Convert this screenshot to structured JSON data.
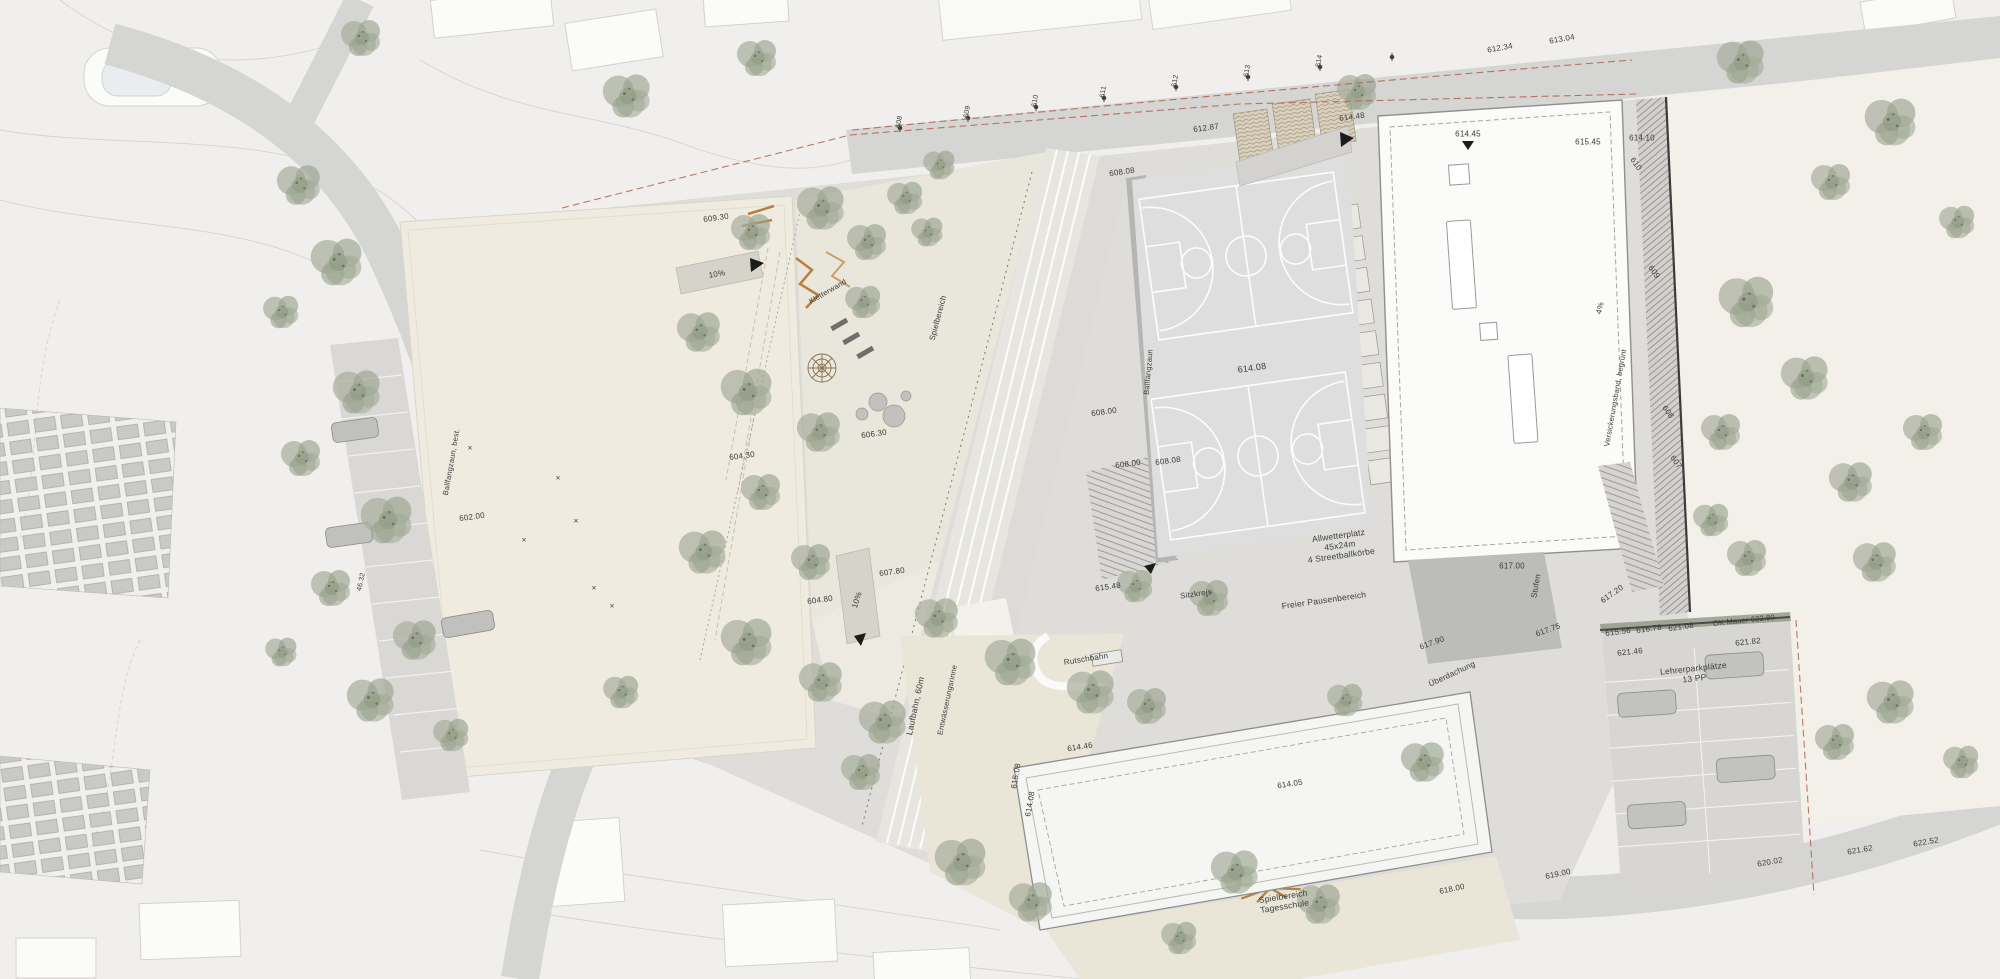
{
  "colors": {
    "ink": "#3a3a38",
    "road": "#d5d5d4",
    "plaza": "#d9d8d5",
    "cream": "#efecdf",
    "beige": "#e9e6d8",
    "lawn": "#f2f0e9",
    "bldg": "#fbfbfa",
    "accent": "#b4604e",
    "tree": "#9aa38f",
    "court_line": "#ffffff",
    "play_equipment": "#b97f3e"
  },
  "legend": {
    "plan_type": "Situationsplan Sportanlagen / Schulareal"
  },
  "annotations": [
    {
      "text": "608",
      "x": 900,
      "y": 122,
      "rot": -80,
      "size": 7,
      "name": "street-elevation"
    },
    {
      "text": "609",
      "x": 968,
      "y": 112,
      "rot": -80,
      "size": 7,
      "name": "street-elevation"
    },
    {
      "text": "610",
      "x": 1036,
      "y": 101,
      "rot": -80,
      "size": 7,
      "name": "street-elevation"
    },
    {
      "text": "611",
      "x": 1104,
      "y": 92,
      "rot": -80,
      "size": 7,
      "name": "street-elevation"
    },
    {
      "text": "612",
      "x": 1176,
      "y": 81,
      "rot": -80,
      "size": 7,
      "name": "street-elevation"
    },
    {
      "text": "613",
      "x": 1248,
      "y": 71,
      "rot": -80,
      "size": 7,
      "name": "street-elevation"
    },
    {
      "text": "614",
      "x": 1320,
      "y": 61,
      "rot": -80,
      "size": 7,
      "name": "street-elevation"
    },
    {
      "text": "612.34",
      "x": 1500,
      "y": 48,
      "rot": -10,
      "size": 8,
      "name": "spot-elevation"
    },
    {
      "text": "613.04",
      "x": 1562,
      "y": 39,
      "rot": -10,
      "size": 8,
      "name": "spot-elevation"
    },
    {
      "text": "612.87",
      "x": 1206,
      "y": 128,
      "rot": -8,
      "size": 8,
      "name": "spot-elevation"
    },
    {
      "text": "614.48",
      "x": 1352,
      "y": 117,
      "rot": -8,
      "size": 8,
      "name": "spot-elevation"
    },
    {
      "text": "614.45",
      "x": 1468,
      "y": 134,
      "rot": 0,
      "size": 8,
      "name": "spot-elevation"
    },
    {
      "text": "615.45",
      "x": 1588,
      "y": 142,
      "rot": 0,
      "size": 8,
      "name": "spot-elevation"
    },
    {
      "text": "614.10",
      "x": 1642,
      "y": 138,
      "rot": 0,
      "size": 8,
      "name": "spot-elevation"
    },
    {
      "text": "610",
      "x": 1636,
      "y": 164,
      "rot": 55,
      "size": 8,
      "name": "contour-label"
    },
    {
      "text": "609",
      "x": 1654,
      "y": 272,
      "rot": 55,
      "size": 8,
      "name": "contour-label"
    },
    {
      "text": "608",
      "x": 1668,
      "y": 412,
      "rot": 55,
      "size": 8,
      "name": "contour-label"
    },
    {
      "text": "607",
      "x": 1676,
      "y": 462,
      "rot": 55,
      "size": 8,
      "name": "contour-label"
    },
    {
      "text": "4%",
      "x": 1600,
      "y": 308,
      "rot": -78,
      "size": 8,
      "name": "slope-label"
    },
    {
      "text": "Versickerungsband, begrünt",
      "x": 1616,
      "y": 398,
      "rot": -80,
      "size": 7.5,
      "name": "feature-label"
    },
    {
      "text": "608.08",
      "x": 1122,
      "y": 172,
      "rot": -8,
      "size": 8,
      "name": "spot-elevation"
    },
    {
      "text": "614.08",
      "x": 1252,
      "y": 368,
      "rot": -8,
      "size": 9,
      "name": "spot-elevation"
    },
    {
      "text": "608.00",
      "x": 1104,
      "y": 412,
      "rot": -8,
      "size": 8,
      "name": "spot-elevation"
    },
    {
      "text": "608.00",
      "x": 1128,
      "y": 464,
      "rot": -8,
      "size": 8,
      "name": "spot-elevation"
    },
    {
      "text": "608.08",
      "x": 1168,
      "y": 461,
      "rot": -8,
      "size": 8,
      "name": "spot-elevation"
    },
    {
      "text": "Ballfangzaun",
      "x": 1149,
      "y": 372,
      "rot": -85,
      "size": 7.5,
      "name": "feature-label"
    },
    {
      "text": "Allwetterplatz\n45x24m\n4 Streetballkörbe",
      "x": 1340,
      "y": 546,
      "rot": -8,
      "size": 8.5,
      "name": "label-allwetterplatz"
    },
    {
      "text": "615.48",
      "x": 1108,
      "y": 587,
      "rot": -8,
      "size": 8,
      "name": "spot-elevation"
    },
    {
      "text": "Sitzkreis",
      "x": 1196,
      "y": 594,
      "rot": -8,
      "size": 8,
      "name": "feature-label"
    },
    {
      "text": "Freier Pausenbereich",
      "x": 1324,
      "y": 601,
      "rot": -8,
      "size": 8.5,
      "name": "label-pausenbereich"
    },
    {
      "text": "617.00",
      "x": 1512,
      "y": 566,
      "rot": 0,
      "size": 8,
      "name": "spot-elevation"
    },
    {
      "text": "617.90",
      "x": 1432,
      "y": 643,
      "rot": -20,
      "size": 8,
      "name": "spot-elevation"
    },
    {
      "text": "617.75",
      "x": 1548,
      "y": 630,
      "rot": -20,
      "size": 8,
      "name": "spot-elevation"
    },
    {
      "text": "Überdachung",
      "x": 1452,
      "y": 674,
      "rot": -25,
      "size": 8,
      "name": "feature-label"
    },
    {
      "text": "Stufen",
      "x": 1536,
      "y": 586,
      "rot": -80,
      "size": 8,
      "name": "feature-label"
    },
    {
      "text": "Laufbahn, 60m",
      "x": 916,
      "y": 706,
      "rot": -78,
      "size": 8.5,
      "name": "label-laufbahn"
    },
    {
      "text": "Entwässerungsrinne",
      "x": 948,
      "y": 700,
      "rot": -78,
      "size": 7.5,
      "name": "feature-label"
    },
    {
      "text": "604.30",
      "x": 742,
      "y": 456,
      "rot": -8,
      "size": 8,
      "name": "spot-elevation"
    },
    {
      "text": "609.30",
      "x": 716,
      "y": 218,
      "rot": -8,
      "size": 8,
      "name": "spot-elevation"
    },
    {
      "text": "10%",
      "x": 717,
      "y": 274,
      "rot": -10,
      "size": 8,
      "name": "slope-label"
    },
    {
      "text": "10%",
      "x": 857,
      "y": 600,
      "rot": -72,
      "size": 8,
      "name": "slope-label"
    },
    {
      "text": "606.30",
      "x": 874,
      "y": 434,
      "rot": -8,
      "size": 8,
      "name": "spot-elevation"
    },
    {
      "text": "607.80",
      "x": 892,
      "y": 572,
      "rot": -8,
      "size": 8,
      "name": "spot-elevation"
    },
    {
      "text": "604.80",
      "x": 820,
      "y": 600,
      "rot": -8,
      "size": 8,
      "name": "spot-elevation"
    },
    {
      "text": "Ballfangzaun, best.",
      "x": 452,
      "y": 462,
      "rot": -80,
      "size": 7.5,
      "name": "feature-label"
    },
    {
      "text": "602.00",
      "x": 472,
      "y": 517,
      "rot": -8,
      "size": 8,
      "name": "spot-elevation"
    },
    {
      "text": "46.32",
      "x": 362,
      "y": 582,
      "rot": -78,
      "size": 7,
      "name": "dimension-label"
    },
    {
      "text": "Spielbereich",
      "x": 938,
      "y": 318,
      "rot": -75,
      "size": 8,
      "name": "label-spielbereich"
    },
    {
      "text": "Kletterwand",
      "x": 828,
      "y": 292,
      "rot": -30,
      "size": 7.5,
      "name": "feature-label"
    },
    {
      "text": "614.46",
      "x": 1080,
      "y": 747,
      "rot": -9,
      "size": 8,
      "name": "spot-elevation"
    },
    {
      "text": "615.08",
      "x": 1016,
      "y": 776,
      "rot": -80,
      "size": 8,
      "name": "spot-elevation"
    },
    {
      "text": "614.08",
      "x": 1030,
      "y": 804,
      "rot": -80,
      "size": 8,
      "name": "spot-elevation"
    },
    {
      "text": "614.05",
      "x": 1290,
      "y": 784,
      "rot": -9,
      "size": 8,
      "name": "spot-elevation"
    },
    {
      "text": "Rutschbahn",
      "x": 1086,
      "y": 659,
      "rot": -9,
      "size": 8,
      "name": "label-rutschbahn"
    },
    {
      "text": "Spielbereich\nTagesschule",
      "x": 1284,
      "y": 902,
      "rot": -9,
      "size": 8.5,
      "name": "label-tagesschule"
    },
    {
      "text": "618.00",
      "x": 1452,
      "y": 889,
      "rot": -12,
      "size": 8,
      "name": "spot-elevation"
    },
    {
      "text": "619.00",
      "x": 1558,
      "y": 874,
      "rot": -12,
      "size": 8,
      "name": "spot-elevation"
    },
    {
      "text": "620.02",
      "x": 1770,
      "y": 862,
      "rot": -10,
      "size": 8,
      "name": "spot-elevation"
    },
    {
      "text": "621.62",
      "x": 1860,
      "y": 850,
      "rot": -10,
      "size": 8,
      "name": "spot-elevation"
    },
    {
      "text": "622.52",
      "x": 1926,
      "y": 842,
      "rot": -10,
      "size": 8,
      "name": "spot-elevation"
    },
    {
      "text": "617.20",
      "x": 1612,
      "y": 594,
      "rot": -35,
      "size": 8,
      "name": "spot-elevation"
    },
    {
      "text": "615.56",
      "x": 1618,
      "y": 632,
      "rot": -8,
      "size": 8,
      "name": "spot-elevation"
    },
    {
      "text": "616.78",
      "x": 1649,
      "y": 629,
      "rot": -8,
      "size": 8,
      "name": "spot-elevation"
    },
    {
      "text": "621.08",
      "x": 1681,
      "y": 627,
      "rot": -8,
      "size": 8,
      "name": "spot-elevation"
    },
    {
      "text": "OK Mauer 622.80",
      "x": 1744,
      "y": 621,
      "rot": -6,
      "size": 7.5,
      "name": "label-mauer"
    },
    {
      "text": "621.82",
      "x": 1748,
      "y": 642,
      "rot": -6,
      "size": 8,
      "name": "spot-elevation"
    },
    {
      "text": "621.46",
      "x": 1630,
      "y": 652,
      "rot": -6,
      "size": 8,
      "name": "spot-elevation"
    },
    {
      "text": "Lehrerparkplätze\n13 PP",
      "x": 1694,
      "y": 674,
      "rot": -6,
      "size": 8.5,
      "name": "label-parkplaetze"
    },
    {
      "text": "×",
      "x": 558,
      "y": 478,
      "rot": 0,
      "size": 8,
      "name": "field-mark"
    },
    {
      "text": "×",
      "x": 594,
      "y": 588,
      "rot": 0,
      "size": 8,
      "name": "field-mark"
    },
    {
      "text": "×",
      "x": 612,
      "y": 606,
      "rot": 0,
      "size": 8,
      "name": "field-mark"
    },
    {
      "text": "×",
      "x": 524,
      "y": 540,
      "rot": 0,
      "size": 8,
      "name": "field-mark"
    },
    {
      "text": "×",
      "x": 576,
      "y": 521,
      "rot": 0,
      "size": 8,
      "name": "field-mark"
    },
    {
      "text": "×",
      "x": 470,
      "y": 448,
      "rot": 0,
      "size": 8,
      "name": "field-mark"
    }
  ]
}
